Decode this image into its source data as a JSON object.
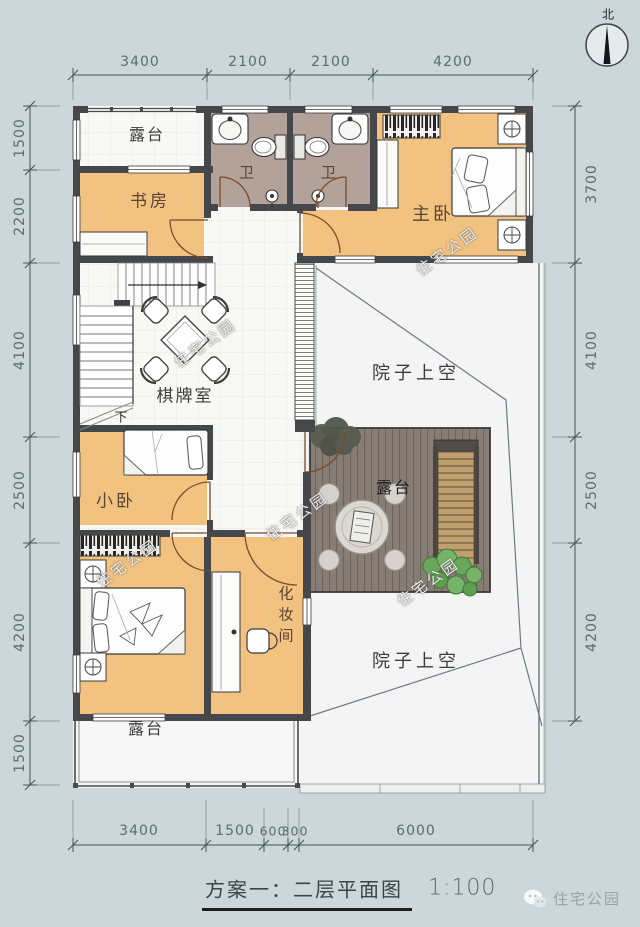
{
  "title": {
    "text": "方案一：二层平面图",
    "scale": "1:100"
  },
  "compass_label": "北",
  "brand": "住宅公园",
  "watermark": "住宅公园",
  "rooms": {
    "terrace_top": "露台",
    "study": "书房",
    "bath_left": "卫",
    "bath_right": "卫",
    "master": "主卧",
    "chess": "棋牌室",
    "court_upper": "院子上空",
    "small_bed": "小卧",
    "deck": "露台",
    "dressing": "化妆间",
    "court_lower": "院子上空",
    "terrace_bottom": "露台",
    "stairs_down": "下"
  },
  "dims": {
    "top": [
      "3400",
      "2100",
      "2100",
      "4200"
    ],
    "bottom": [
      "3400",
      "1500",
      "600",
      "300",
      "6000"
    ],
    "left": [
      "1500",
      "2200",
      "4100",
      "2500",
      "4200",
      "1500"
    ],
    "right": [
      "3700",
      "4100",
      "2500",
      "4200"
    ]
  },
  "colors": {
    "background": "#ccd7d9",
    "room_fill": "#f1c280",
    "bath_fill": "#b3a29a",
    "deck_fill": "#877d74",
    "wall": "#46474b"
  }
}
